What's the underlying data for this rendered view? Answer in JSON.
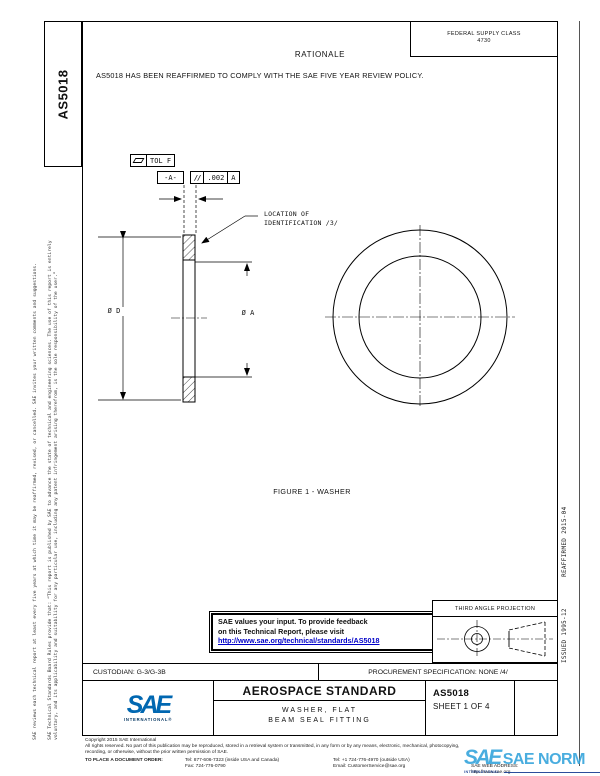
{
  "doc": {
    "number_side": "AS5018",
    "fsc_line1": "FEDERAL SUPPLY CLASS",
    "fsc_line2": "4730",
    "rationale_heading": "RATIONALE",
    "rationale_body": "AS5018 HAS BEEN REAFFIRMED TO COMPLY WITH THE SAE FIVE YEAR REVIEW POLICY."
  },
  "margins": {
    "left_note_1": "SAE Technical Standards Board Rules provide that: “This report is published by SAE to advance the state of technical and engineering sciences. The use of this report is entirely voluntary, and its applicability and suitability for any particular use, including any patent infringement arising therefrom, is the sole responsibility of the user.”",
    "left_note_2": "SAE reviews each technical report at least every five years at which time it may be reaffirmed, revised, or cancelled. SAE invites your written comments and suggestions.",
    "right_note": "ISSUED 1995-12        REAFFIRMED 2015-04"
  },
  "drawing": {
    "flatness_label": "TOL F",
    "datum_flag": "-A-",
    "parallelism_symbol": "//",
    "parallelism_value": ".002",
    "parallelism_datum": "A",
    "id_note_line1": "LOCATION OF",
    "id_note_line2": "IDENTIFICATION /3/",
    "outer_diameter_label": "Ø D",
    "inner_diameter_label": "Ø A",
    "caption": "FIGURE 1 - WASHER"
  },
  "feedback": {
    "line1": "SAE values your input. To provide feedback",
    "line2": "on this Technical Report, please visit",
    "link": "http://www.sae.org/technical/standards/AS5018"
  },
  "projection": {
    "title": "THIRD ANGLE PROJECTION"
  },
  "title_block": {
    "custodian": "CUSTODIAN: G-3/G-3B",
    "procurement": "PROCUREMENT SPECIFICATION: NONE /4/",
    "logo_text": "SAE",
    "logo_subtext": "INTERNATIONAL®",
    "doc_type": "AEROSPACE STANDARD",
    "title_line1": "WASHER, FLAT",
    "title_line2": "BEAM SEAL FITTING",
    "doc_number": "AS5018",
    "sheet_label": "SHEET 1 OF 4"
  },
  "footer": {
    "copyright": "Copyright 2015 SAE International",
    "rights_line1": "All rights reserved. No part of this publication may be reproduced, stored in a retrieval system or transmitted, in any form or by any means, electronic, mechanical, photocopying,",
    "rights_line2": "recording, or otherwise, without the prior written permission of SAE.",
    "order_label": "TO PLACE A DOCUMENT ORDER:",
    "tel_inside": "Tel: 877-606-7323 (inside USA and Canada)",
    "tel_outside": "Tel: +1 724-776-4970 (outside USA)",
    "fax": "Fax: 724-776-0790",
    "email": "Email: CustomerService@sae.org",
    "web": "SAE WEB ADDRESS: http://www.sae.org"
  },
  "watermark": {
    "logo": "SAE",
    "name": "SAE NORM",
    "subtext": "INTERNATIONAL."
  },
  "colors": {
    "link_blue": "#0000c8",
    "sae_blue": "#0067b1",
    "watermark_blue": "#3aa7dd"
  }
}
